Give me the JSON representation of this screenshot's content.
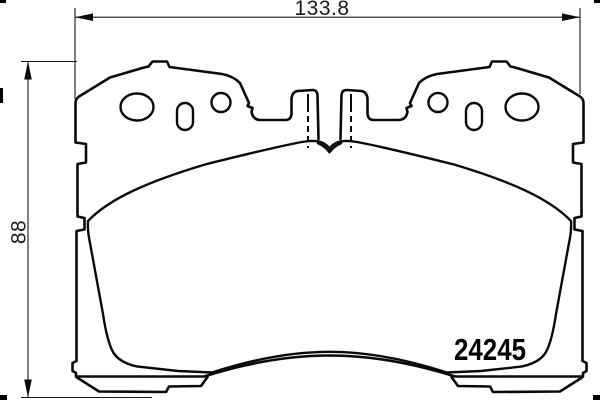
{
  "document": {
    "kind": "brake-pad-technical-drawing",
    "background_color": "#ffffff",
    "line_color": "#0a0a0a"
  },
  "annotations": {
    "width_dimension": "133.8",
    "height_dimension": "88",
    "part_number": "24245"
  },
  "drawing": {
    "pad_count": 2,
    "holes_per_pad": 3
  }
}
